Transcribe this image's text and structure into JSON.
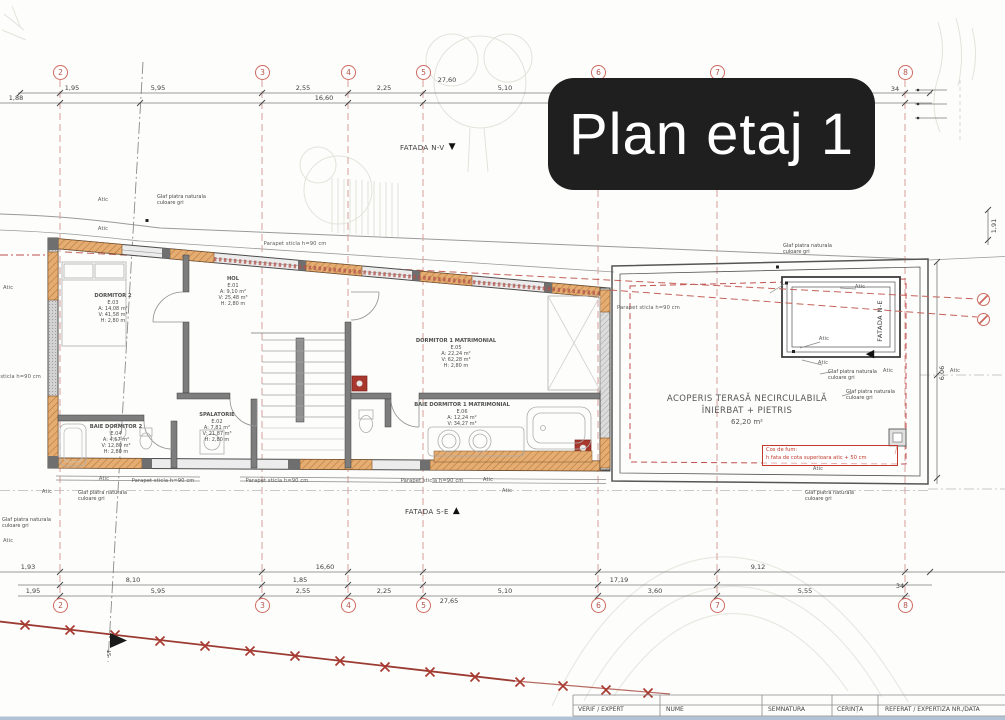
{
  "title_card": {
    "text": "Plan etaj 1"
  },
  "facades": {
    "nv": "FATADA N-V",
    "se": "FATADA S-E",
    "ne": "FATADA N-E"
  },
  "icons": {
    "tri_down": "▼",
    "tri_up": "▲",
    "tri_left": "◀"
  },
  "grid": {
    "axes": [
      "2",
      "3",
      "4",
      "5",
      "6",
      "7",
      "8"
    ]
  },
  "labels": {
    "atic": "Atic",
    "parapet": "Parapet sticla h=90 cm",
    "glaf1": "Glaf piatra naturala",
    "glaf2": "culoare gri",
    "st": "ST"
  },
  "rooms": {
    "dormitor2": {
      "name": "DORMITOR 2",
      "code": "E.03",
      "area": "A: 14,08 m²",
      "volume": "V: 41,58 m³",
      "height": "H: 2,80 m"
    },
    "hol": {
      "name": "HOL",
      "code": "E.01",
      "area": "A: 9,10 m²",
      "volume": "V: 25,48 m³",
      "height": "H: 2,80 m"
    },
    "spalatorie": {
      "name": "SPALATORIE",
      "code": "E.02",
      "area": "A: 7,81 m²",
      "volume": "V: 21,87 m³",
      "height": "H: 2,80 m"
    },
    "baie_dormitor2": {
      "name": "BAIE DORMITOR 2",
      "code": "E.04",
      "area": "A: 4,57 m²",
      "volume": "V: 12,80 m³",
      "height": "H: 2,80 m"
    },
    "dormitor1": {
      "name": "DORMITOR 1 MATRIMONIAL",
      "code": "E.05",
      "area": "A: 22,24 m²",
      "volume": "V: 62,28 m³",
      "height": "H: 2,80 m"
    },
    "baie_dormitor1": {
      "name": "BAIE DORMITOR 1 MATRIMONIAL",
      "code": "E.06",
      "area": "A: 12,24 m²",
      "volume": "V: 34,27 m³",
      "height": "H: 2,80 m"
    }
  },
  "terrace": {
    "line1": "ACOPERIS TERASĂ NECIRCULABILĂ",
    "line2": "ÎNIERBAT + PIETRIS",
    "line3": "62,20 m²"
  },
  "chimney_note": {
    "line1": "Cos de fum:",
    "line2": "h fata de cota superioara atic + 50 cm"
  },
  "dimensions": {
    "top": {
      "d1": "1,95",
      "d2": "5,95",
      "d3": "2,55",
      "d4": "2,25",
      "d5": "27,60",
      "d6": "5,10",
      "d7": "34",
      "d8": "1,88",
      "d9": "16,60"
    },
    "bottom": {
      "d1": "1,93",
      "d2": "16,60",
      "d3": "9,12",
      "d4": "8,10",
      "d5": "1,85",
      "d6": "17,19",
      "d7": "1,95",
      "d8": "5,95",
      "d9": "2,55",
      "d10": "2,25",
      "d11": "5,10",
      "d12": "3,60",
      "d13": "5,55",
      "d14": "34",
      "d15": "27,65"
    },
    "right": {
      "d1": "1,91",
      "d2": "6,06"
    }
  },
  "table": {
    "headers": [
      "VERIF / EXPERT",
      "NUME",
      "SEMNATURA",
      "CERINȚA",
      "REFERAT / EXPERTIZA NR./DATA"
    ]
  },
  "colors": {
    "accent_red": "#c0392b",
    "grid_red": "#cf6a5f",
    "masonry_orange": "#e5ad72",
    "wall_gray": "#7d7d7d"
  }
}
